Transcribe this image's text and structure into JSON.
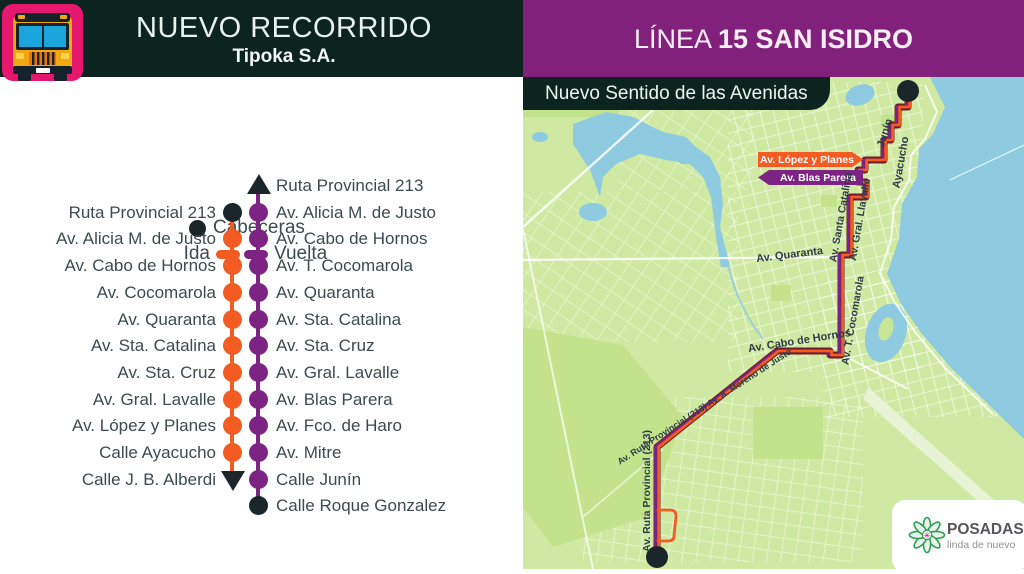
{
  "header": {
    "title": "NUEVO RECORRIDO",
    "subtitle": "Tipoka S.A."
  },
  "line_header": {
    "prefix": "LÍNEA ",
    "name": "15 SAN ISIDRO"
  },
  "map_badge": "Nuevo Sentido de las Avenidas",
  "legend": {
    "cabeceras": "Cabeceras",
    "ida": "Ida",
    "vuelta": "Vuelta"
  },
  "route_diagram": {
    "ida_stops": [
      "Ruta Provincial 213",
      "Av. Alicia M. de Justo",
      "Av. Cabo de Hornos",
      "Av. Cocomarola",
      "Av. Quaranta",
      "Av. Sta. Catalina",
      "Av. Sta. Cruz",
      "Av. Gral. Lavalle",
      "Av. López y Planes",
      "Calle Ayacucho",
      "Calle J. B. Alberdi"
    ],
    "vuelta_stops": [
      "Ruta Provincial 213",
      "Av. Alicia M. de Justo",
      "Av. Cabo de Hornos",
      "Av. T. Cocomarola",
      "Av. Quaranta",
      "Av. Sta. Catalina",
      "Av. Sta. Cruz",
      "Av. Gral. Lavalle",
      "Av. Blas Parera",
      "Av. Fco. de Haro",
      "Av. Mitre",
      "Calle Junín",
      "Calle Roque Gonzalez"
    ]
  },
  "map": {
    "banners": {
      "lopez": "Av. López y Planes",
      "blas": "Av. Blas Parera"
    },
    "street_labels": [
      {
        "text": "Junín",
        "x": 365,
        "y": 57,
        "rot": -72,
        "size": 11
      },
      {
        "text": "Ayacucho",
        "x": 381,
        "y": 86,
        "rot": -80,
        "size": 11
      },
      {
        "text": "Av. Santa Catalina",
        "x": 321,
        "y": 141,
        "rot": -80,
        "size": 10.5
      },
      {
        "text": "Av. Gral. Llavalle",
        "x": 340,
        "y": 143,
        "rot": -80,
        "size": 10.5
      },
      {
        "text": "Av. Quaranta",
        "x": 267,
        "y": 181,
        "rot": -7,
        "size": 11
      },
      {
        "text": "Av. T. Cocomarola",
        "x": 333,
        "y": 244,
        "rot": -80,
        "size": 10.5
      },
      {
        "text": "Av. Cabo de Hornos",
        "x": 277,
        "y": 267,
        "rot": -9,
        "size": 11
      },
      {
        "text": "Av. Ruta Provincial (213) Av. A. Moreno de Justo",
        "x": 183,
        "y": 332,
        "rot": -33,
        "size": 9
      },
      {
        "text": "Av. Ruta Provincial (213)",
        "x": 127,
        "y": 414,
        "rot": -90,
        "size": 10.5
      }
    ],
    "logo": {
      "name": "POSADAS",
      "tagline": "linda de nuevo"
    }
  },
  "colors": {
    "dark_header": "#0c2420",
    "purple_header": "#82217c",
    "ida_orange": "#f25b22",
    "vuelta_purple": "#7d2384",
    "land": "#cfe9a2",
    "water": "#8ecbe0",
    "text": "#3c4b4f",
    "bus_icon_pink": "#e6186e",
    "bus_yellow": "#f3a712"
  }
}
